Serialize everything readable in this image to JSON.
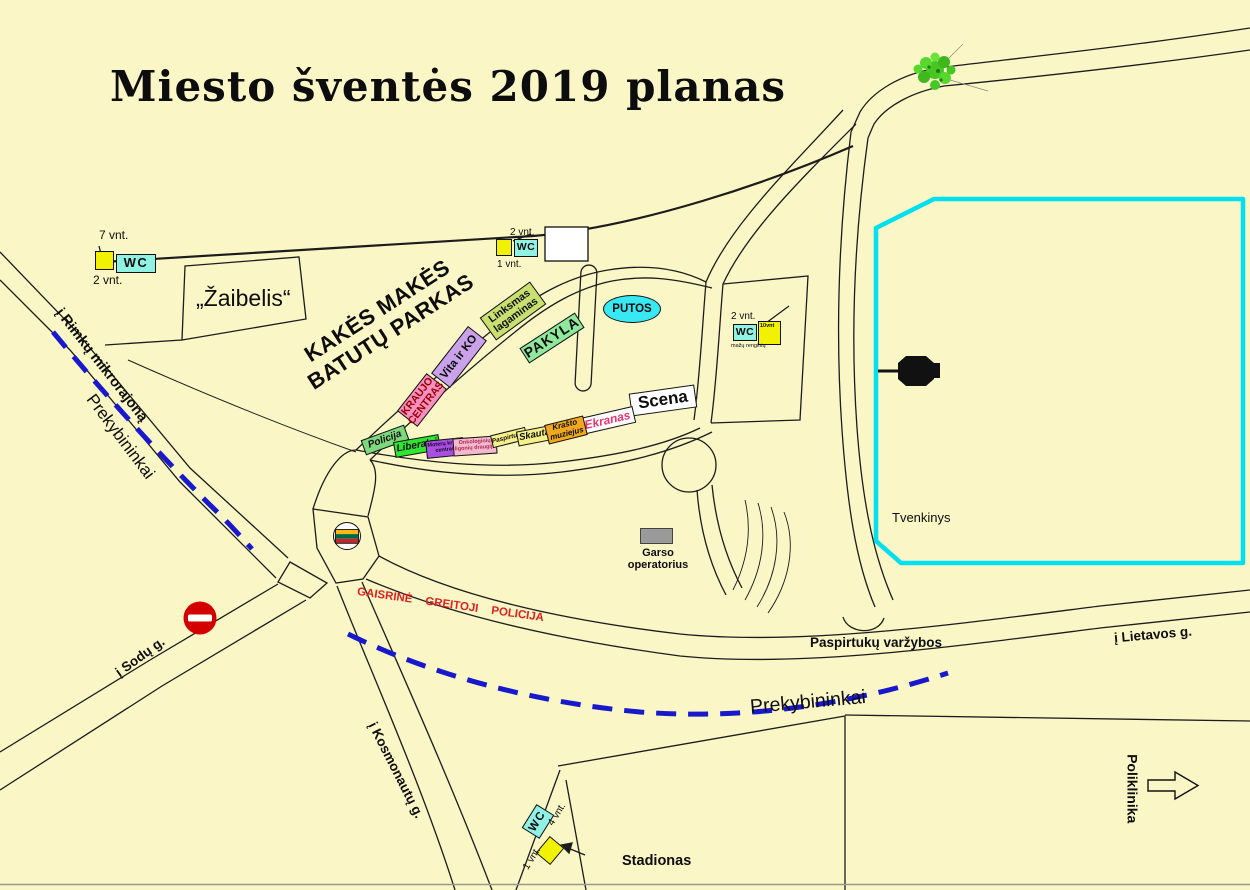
{
  "title": "Miesto šventės 2019 planas",
  "park": {
    "line1": "KAKĖS MAKĖS",
    "line2": "BATUTŲ PARKAS"
  },
  "areas": {
    "zaibelis": "„Žaibelis“",
    "tvenkinys": "Tvenkinys",
    "stadionas": "Stadionas",
    "poliklinika": "Poliklinika"
  },
  "venues": {
    "putos": "PUTOS",
    "scena": "Scena",
    "ekranas": "Ekranas",
    "pakyla": "PAKYLA",
    "vita": "Vita ir KO",
    "linksmas": {
      "line1": "Linksmas",
      "line2": "lagaminas"
    },
    "kraujo": {
      "line1": "KRAUJO",
      "line2": "CENTRAS"
    },
    "garso": {
      "line1": "Garso",
      "line2": "operatorius"
    }
  },
  "booths": [
    {
      "label": "Policija",
      "fill": "#7ED87E"
    },
    {
      "label": "Liberalai",
      "fill": "#2FE52F"
    },
    {
      "line1": "Moterų krizių",
      "line2": "centras",
      "fill": "#AA50E0"
    },
    {
      "line1": "Onkologinių",
      "line2": "ligonių draugija",
      "fill": "#F2BACC"
    },
    {
      "label": "Paspirtukai",
      "fill": "#F5F08A"
    },
    {
      "label": "Skautai",
      "fill": "#F5F08A"
    },
    {
      "line1": "Krašto",
      "line2": "muziejus",
      "fill": "#F0A81C"
    }
  ],
  "roads": {
    "rimku": "į Rimkų mikrorajoną",
    "prekybininkai_left": "Prekybininkai",
    "prekybininkai_bottom": "Prekybininkai",
    "sodu": "į Sodų g.",
    "kosmonautu": "į Kosmonautų g.",
    "lietavos": "į Lietavos g.",
    "gaisrine": "GAISRINĖ GREITOJI POLICIJA",
    "paspirtuku": "Paspirtukų varžybos"
  },
  "wc": {
    "label": "WC",
    "nw_line_count": "7 vnt.",
    "nw_count": "2 vnt.",
    "n_count_top": "2 vnt.",
    "n_count_bottom": "1 vnt.",
    "e_count_top": "2 vnt.",
    "e_box_count": "10vnt",
    "e_note": "mažų renginių",
    "s_count_top": "4 vnt.",
    "s_count_bottom": "1 vnt."
  },
  "palette": {
    "background": "#FAF6C6",
    "wc_cyan": "#8FF2E4",
    "unit_yellow": "#F2F200",
    "pond_outline": "#00E0F0",
    "dashed_route_blue": "#1818CC",
    "emergency_red": "#E02020",
    "no_entry_red": "#D40000",
    "putos_cyan": "#38E8F2",
    "pakyla_green": "#90E89C",
    "vita_purple": "#C9A2EA",
    "kraujo_pink": "#F790BE",
    "linksmas_green": "#C9E070",
    "ekranas_text": "#F0326E"
  }
}
